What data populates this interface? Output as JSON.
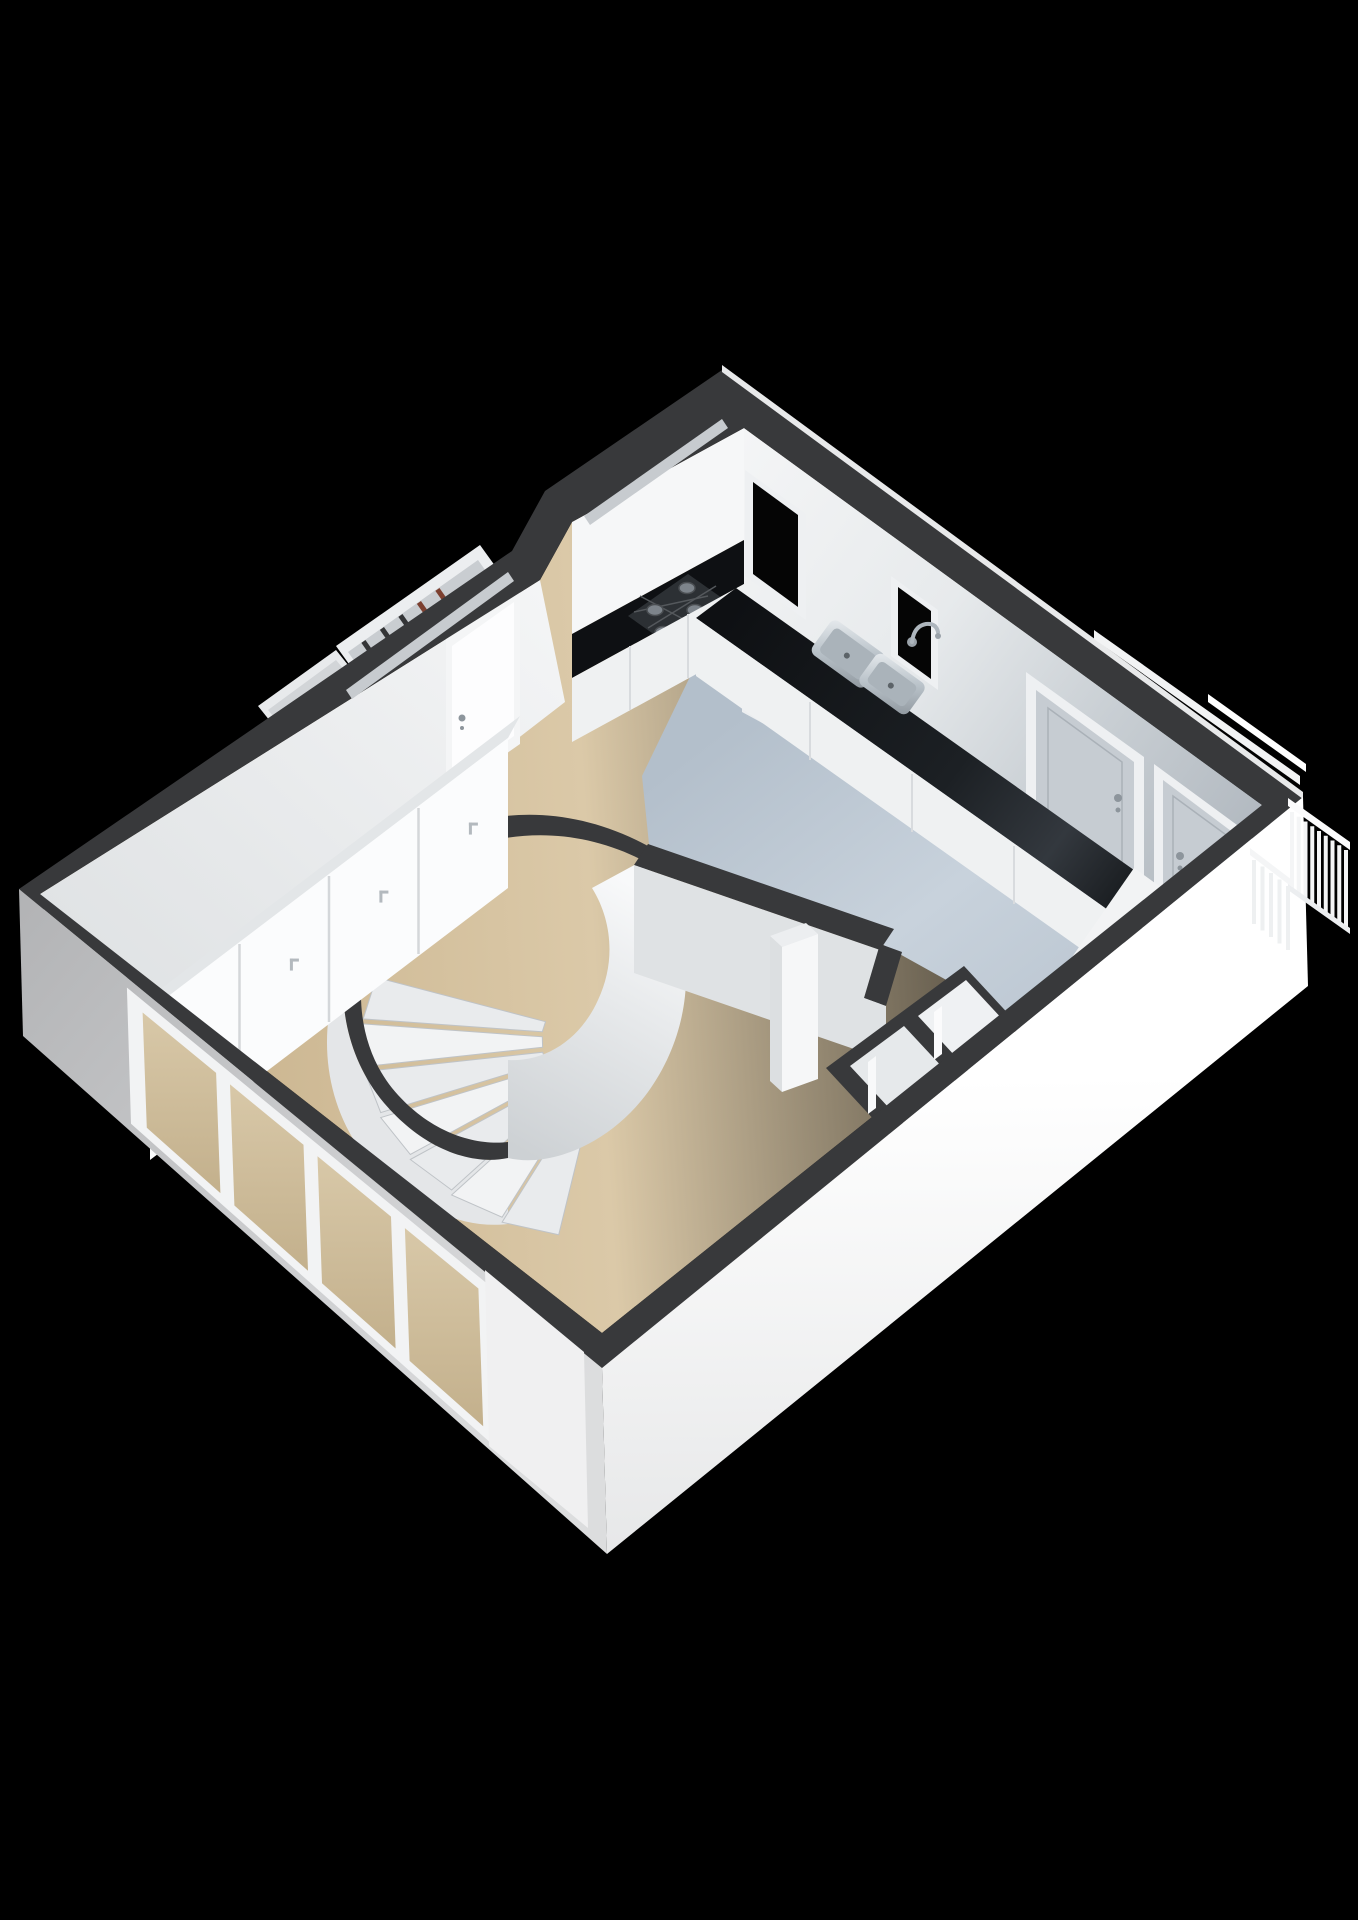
{
  "scene": {
    "description": "3D isometric cutaway floor-plan render of an apartment ground floor on a black background",
    "background": "#000000"
  },
  "palette": {
    "bg": "#000000",
    "wall_cut": "#38393b",
    "wall_cut_dark": "#2e2f31",
    "wall_white": "#f4f5f6",
    "wall_shade": "#dfe2e4",
    "wall_gray": "#c2c8cd",
    "exterior_white": "#fafafa",
    "exterior_gray": "#bfc0c2",
    "floor_beige": "#d3bf9d",
    "floor_beige_dark": "#c4ad86",
    "floor_kitchen": "#c4ced8",
    "floor_kitchen_dark": "#a9b5c1",
    "counter_dark": "#16191d",
    "hob_dark": "#2c3034",
    "burner_gray": "#7d848b",
    "cabinet_white": "#eff1f2",
    "steel_light": "#cdd5da",
    "steel_dark": "#8f979e",
    "door_gray": "#c6ccd2",
    "frame_white": "#eef0f2",
    "glass_void": "#050505",
    "glass_beige": "#cdbc9b",
    "trim_white": "#f6f7f8",
    "handle_gray": "#8d959c",
    "item_dark": "#333436",
    "item_rust": "#7c4030"
  },
  "structure": {
    "floors": [
      {
        "name": "living-room-floor",
        "material_color_ref": "floor_beige"
      },
      {
        "name": "kitchen-floor",
        "material_color_ref": "floor_kitchen"
      }
    ],
    "staircase": {
      "type": "curved",
      "steps": 7
    },
    "kitchen": {
      "hob_burners": 4,
      "sink_basins": 2,
      "faucets": 1,
      "cabinet_seams": 3
    },
    "wardrobe": {
      "doors": 4
    },
    "meter_cupboard": {
      "items_dark": 3,
      "items_rust": 2
    },
    "windows": [
      {
        "name": "kitchen-window-large"
      },
      {
        "name": "kitchen-window-small"
      }
    ],
    "ribbon_windows": 2,
    "doors": {
      "gray_interior_doors": 2,
      "entrance_door": 1
    },
    "hall_closets": 2,
    "glazed_facade": {
      "panes": 4,
      "mullions": 3
    },
    "balcony": {
      "panel1_balusters": 9,
      "panel2_balusters": 5
    }
  }
}
